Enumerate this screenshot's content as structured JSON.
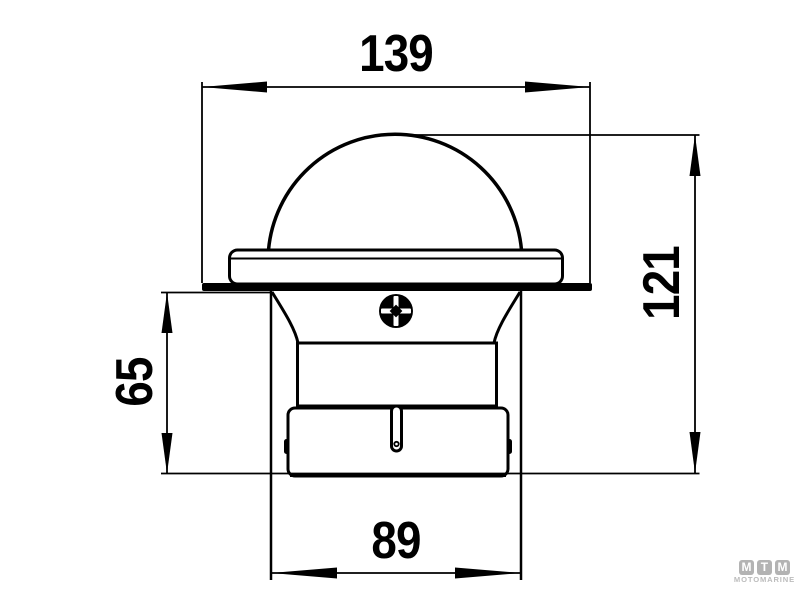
{
  "drawing": {
    "type": "technical-drawing",
    "line_color": "#000000",
    "background_color": "#ffffff",
    "dimension_labels": {
      "top_width": "139",
      "overall_height": "121",
      "recess_depth": "65",
      "body_width": "89"
    }
  },
  "watermark": {
    "letters": [
      "M",
      "T",
      "M"
    ],
    "name": "MOTOMARINE",
    "color": "#b3b3b3"
  }
}
